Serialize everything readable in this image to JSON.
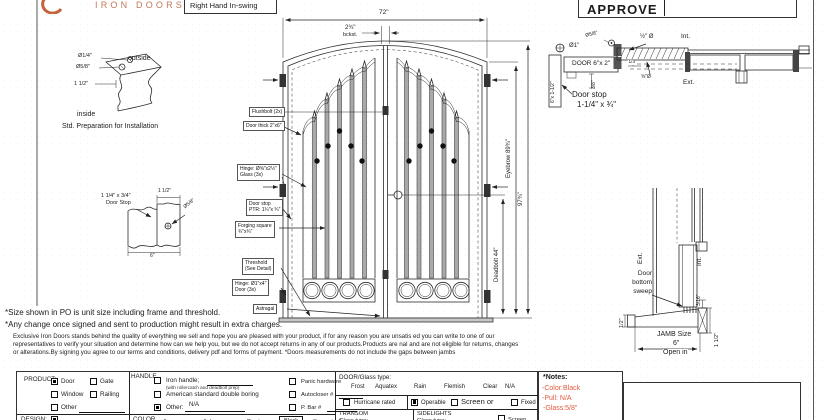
{
  "header": {
    "brand": "IRON DOORS",
    "swing_label": "Right Hand In-swing",
    "approve_label": "APPROVE"
  },
  "colors": {
    "brand": "#c0795b",
    "note_red": "#e2593d"
  },
  "prep_detail": {
    "dia_quarter": "Ø1/4\"",
    "dia_five_eighths": "Ø5/8\"",
    "one_half_dim": "1 1/2\"",
    "outside": "outside",
    "inside": "inside",
    "caption": "Std. Preparation for Installation"
  },
  "doorstop_detail": {
    "size_line": "1 1/4\" x 3/4\"",
    "name_line": "Door Stop",
    "dim": "1 1/2\"",
    "dia": "Ø5/8\"",
    "width": "6\""
  },
  "elevation": {
    "width_dim": "72\"",
    "backset": "2¾\"",
    "backset_label": "bckst.",
    "eyebrow_dim": "Eyebrow 89¾\"",
    "overall_dim": "97¾\"",
    "deadbolt_dim": "Deadbolt 44\"",
    "callouts": {
      "flushbolt": "Flushbolt (2x)",
      "door_thick": "Door thick 2\"x6\"",
      "hinge_glass_l1": "Hinge: Ø⅝\"x2½\"",
      "hinge_glass_l2": "Glass (3x)",
      "doorstop_l1": "Door stop",
      "doorstop_l2": "PTR: 1¼\"x ¾\"",
      "forging_l1": "Forging square",
      "forging_l2": "¾\"x¾\"",
      "threshold_l1": "Threshold",
      "threshold_l2": "(See Detail)",
      "hinge_door_l1": "Hinge: Ø1\"x4\"",
      "hinge_door_l2": "Door (3x)",
      "astragal": "Astragal"
    }
  },
  "head_section": {
    "dia_one": "Ø1\"",
    "dia_five_eighths": "Ø5/8\"",
    "door_label": "DOOR 6\"x 2\"",
    "half_dia": "½\" Ø",
    "quarter": "1/4\"",
    "five_eighths_dia": "⅝\"Ø",
    "int_label": "Int.",
    "ext_label": "Ext.",
    "jamb_size": "6\"x 1-1/2\"",
    "three_eighths": "3/8\"",
    "doorstop_l1": "Door stop",
    "doorstop_l2": "1-1/4\" x ¾\""
  },
  "sill_section": {
    "ext_label": "Ext.",
    "int_label": "Int.",
    "sweep_l1": "Door",
    "sweep_l2": "bottom",
    "sweep_l3": "sweep",
    "half_dim": "1/2\"",
    "gap_dim": "3/16\"",
    "jamb_l1": "JAMB Size",
    "jamb_l2": "6\"",
    "jamb_l3": "Open in",
    "height_dim": "1 1/2\""
  },
  "notes": {
    "line1": "*Size shown in PO is unit size including frame and threshold.",
    "line2": "*Any change once signed and sent to production might result in extra charges.",
    "fine1": "Exclusive Iron Doors stands behind the quality of everything we sell and hope you are pleased with your product, if for any reason you are unsatis  ed you can write to one of our",
    "fine2": "representatives to verify your situation and determine how can we help you, but we do not accept returns in any of our products.Products are   nal and are not eligible for returns, changes",
    "fine3": "or alterations.By signing you agree to our terms and conditions, delivery pdf and forms of payment. *Doors measurements do not include the gaps between jambs"
  },
  "form": {
    "product": {
      "label": "PRODUCT:",
      "opt_door": {
        "label": "Door",
        "checked": true
      },
      "opt_gate": {
        "label": "Gate",
        "checked": false
      },
      "opt_window": {
        "label": "Window",
        "checked": false
      },
      "opt_railing": {
        "label": "Railing",
        "checked": false
      },
      "opt_other": {
        "label": "Other",
        "checked": false
      }
    },
    "handle": {
      "label": "HANDLE",
      "opt_iron": {
        "label": "Iron handle;",
        "checked": false
      },
      "iron_note": "(with rollercatch and deadbolt prep)",
      "opt_american": {
        "label": "American standard double boring",
        "checked": false
      },
      "opt_other": {
        "label": "Other:",
        "checked": true,
        "value": "N/A"
      }
    },
    "hardware": {
      "opt_panic": {
        "label": "Panic hardware",
        "checked": false
      },
      "opt_autocloser": {
        "label": "Autocloser #",
        "checked": false
      },
      "opt_pbar": {
        "label": "P. Bar #",
        "checked": false
      }
    },
    "glass": {
      "label": "DOOR/Glass type:",
      "types": [
        "Frost",
        "Aquatex",
        "Rain",
        "Flemish",
        "Clear",
        "N/A"
      ],
      "opt_hurricane": {
        "label": "Hurricane rated",
        "checked": false
      },
      "opt_operable": {
        "label": "Operable",
        "checked": true
      },
      "opt_screen": {
        "label": "Screen or",
        "checked": false
      },
      "opt_fixed": {
        "label": "Fixed",
        "checked": false
      }
    },
    "notes_box": {
      "title": "*Notes:",
      "color": "-Color:Black",
      "pull": "-Pull: N/A",
      "glass": "-Glass:5/8\""
    },
    "bottom": {
      "design_label": "DESIGN:",
      "color_label": "COLOR",
      "colors": [
        "A. green",
        "A. bronze",
        "Pewter",
        "Black",
        "See notes*"
      ],
      "transom_l1": "TRANSOM",
      "transom_l2": "Glass type:",
      "sidelights_l1": "SIDELIGHTS",
      "sidelights_l2": "Glass type:",
      "opt_screen": {
        "label": "Screen",
        "checked": false
      }
    }
  }
}
